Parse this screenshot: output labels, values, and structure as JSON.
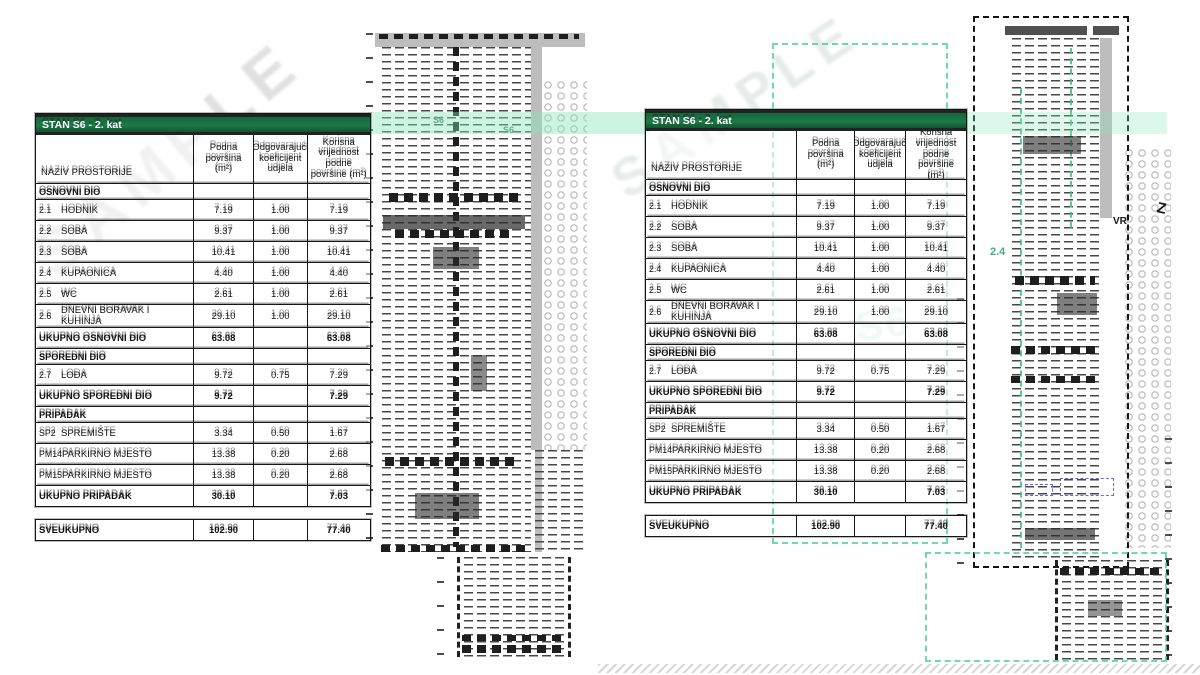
{
  "doc": {
    "watermark": "SAMPLE",
    "colors": {
      "header_green": "#1c7a49",
      "band_green": "#84e8b6",
      "teal_dash": "#48d2a2",
      "blue_dash": "#6a6ad8"
    }
  },
  "table": {
    "title": "STAN S6 - 2. kat",
    "columns": [
      "NAZIV PROSTORIJE",
      "Podna površina (m²)",
      "Odgovarajući koeficijent udjela",
      "Korisna vrijednost podne površine (m²)"
    ],
    "sections": [
      {
        "header": "OSNOVNI DIO",
        "rows": [
          {
            "code": "2.1",
            "name": "HODNIK",
            "area": "7.19",
            "coef": "1.00",
            "value": "7.19"
          },
          {
            "code": "2.2",
            "name": "SOBA",
            "area": "9.37",
            "coef": "1.00",
            "value": "9.37"
          },
          {
            "code": "2.3",
            "name": "SOBA",
            "area": "10.41",
            "coef": "1.00",
            "value": "10.41"
          },
          {
            "code": "2.4",
            "name": "KUPAONICA",
            "area": "4.40",
            "coef": "1.00",
            "value": "4.40"
          },
          {
            "code": "2.5",
            "name": "WC",
            "area": "2.61",
            "coef": "1.00",
            "value": "2.61"
          },
          {
            "code": "2.6",
            "name": "DNEVNI BORAVAK I KUHINJA",
            "area": "29.10",
            "coef": "1.00",
            "value": "29.10"
          }
        ],
        "total": {
          "label": "UKUPNO OSNOVNI DIO",
          "area": "63.08",
          "coef": "",
          "value": "63.08"
        }
      },
      {
        "header": "SPOREDNI DIO",
        "rows": [
          {
            "code": "2.7",
            "name": "LOĐA",
            "area": "9.72",
            "coef": "0.75",
            "value": "7.29"
          }
        ],
        "total": {
          "label": "UKUPNO SPOREDNI DIO",
          "area": "9.72",
          "coef": "",
          "value": "7.29"
        }
      },
      {
        "header": "PRIPADAK",
        "rows": [
          {
            "code": "SP2",
            "name": "SPREMIŠTE",
            "area": "3.34",
            "coef": "0.50",
            "value": "1.67"
          },
          {
            "code": "PM14",
            "name": "PARKIRNO MJESTO",
            "area": "13.38",
            "coef": "0.20",
            "value": "2.68"
          },
          {
            "code": "PM15",
            "name": "PARKIRNO MJESTO",
            "area": "13.38",
            "coef": "0.20",
            "value": "2.68"
          }
        ],
        "total": {
          "label": "UKUPNO PRIPADAK",
          "area": "30.10",
          "coef": "",
          "value": "7.03"
        }
      }
    ],
    "grand_total": {
      "label": "SVEUKUPNO",
      "area": "102.90",
      "coef": "",
      "value": "77.40"
    }
  },
  "plans": {
    "center": {
      "unit_label_1": "S6",
      "unit_label_2": "S6"
    },
    "right": {
      "room_label": "2.4",
      "mark_label": "VR",
      "edge_mark": "Z"
    }
  }
}
